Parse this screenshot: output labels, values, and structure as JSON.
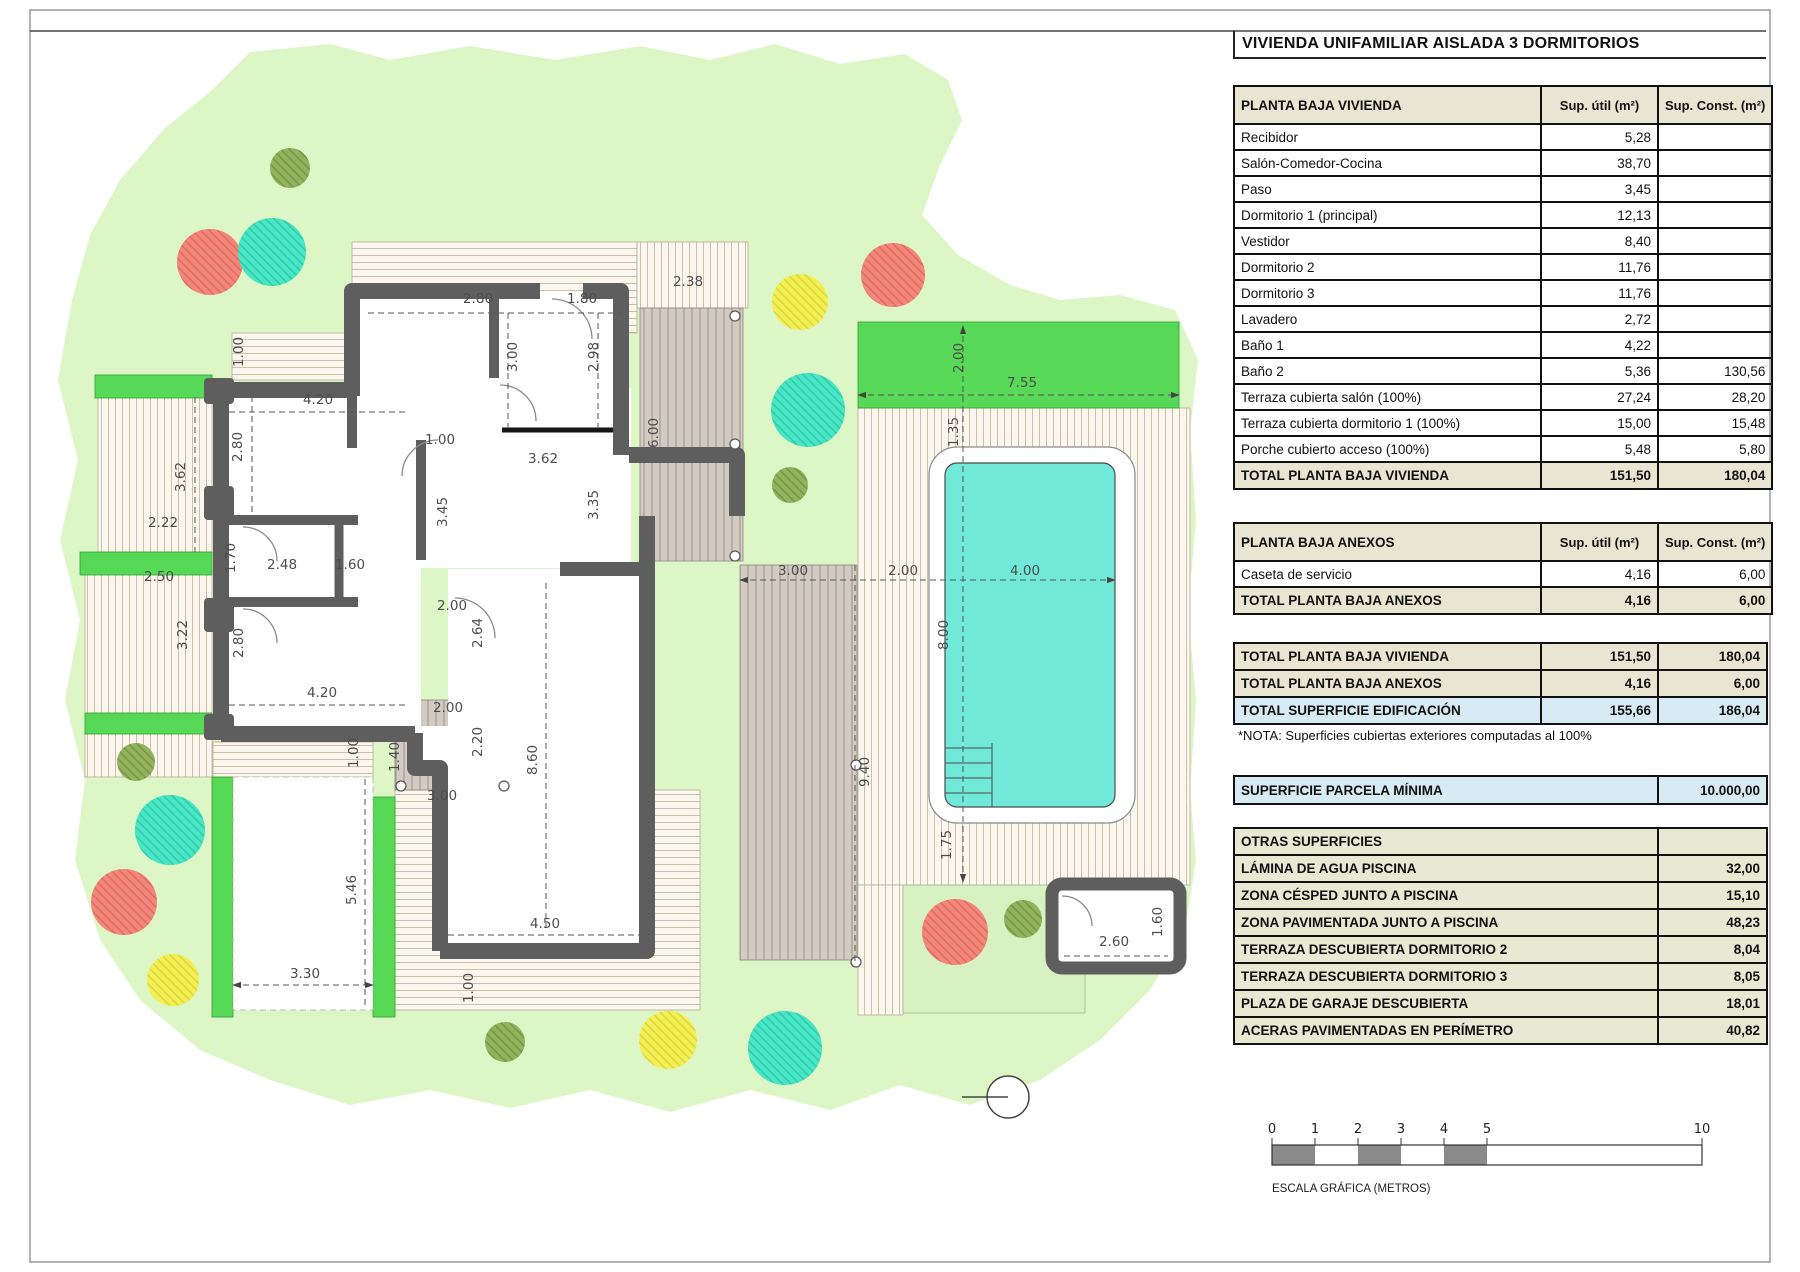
{
  "title": "VIVIENDA UNIFAMILIAR AISLADA 3 DORMITORIOS",
  "tables": {
    "planta_baja": {
      "header": "PLANTA BAJA VIVIENDA",
      "col_util": "Sup. útil\n(m²)",
      "col_const": "Sup. Const.\n(m²)",
      "rows": [
        {
          "label": "Recibidor",
          "util": "5,28",
          "const": ""
        },
        {
          "label": "Salón-Comedor-Cocina",
          "util": "38,70",
          "const": ""
        },
        {
          "label": "Paso",
          "util": "3,45",
          "const": ""
        },
        {
          "label": "Dormitorio 1 (principal)",
          "util": "12,13",
          "const": ""
        },
        {
          "label": "Vestidor",
          "util": "8,40",
          "const": ""
        },
        {
          "label": "Dormitorio 2",
          "util": "11,76",
          "const": ""
        },
        {
          "label": "Dormitorio 3",
          "util": "11,76",
          "const": ""
        },
        {
          "label": "Lavadero",
          "util": "2,72",
          "const": ""
        },
        {
          "label": "Baño 1",
          "util": "4,22",
          "const": ""
        },
        {
          "label": "Baño 2",
          "util": "5,36",
          "const": "130,56"
        },
        {
          "label": "Terraza cubierta salón (100%)",
          "util": "27,24",
          "const": "28,20"
        },
        {
          "label": "Terraza cubierta dormitorio 1 (100%)",
          "util": "15,00",
          "const": "15,48"
        },
        {
          "label": "Porche cubierto acceso (100%)",
          "util": "5,48",
          "const": "5,80"
        }
      ],
      "total": {
        "label": "TOTAL PLANTA BAJA VIVIENDA",
        "util": "151,50",
        "const": "180,04"
      }
    },
    "anexos": {
      "header": "PLANTA BAJA ANEXOS",
      "col_util": "Sup. útil\n(m²)",
      "col_const": "Sup. Const.\n(m²)",
      "rows": [
        {
          "label": "Caseta de servicio",
          "util": "4,16",
          "const": "6,00"
        }
      ],
      "total": {
        "label": "TOTAL PLANTA BAJA ANEXOS",
        "util": "4,16",
        "const": "6,00"
      }
    },
    "resumen": {
      "rows": [
        {
          "label": "TOTAL PLANTA BAJA VIVIENDA",
          "util": "151,50",
          "const": "180,04",
          "style": "tot"
        },
        {
          "label": "TOTAL PLANTA BAJA ANEXOS",
          "util": "4,16",
          "const": "6,00",
          "style": "tot"
        },
        {
          "label": "TOTAL SUPERFICIE EDIFICACIÓN",
          "util": "155,66",
          "const": "186,04",
          "style": "blue"
        }
      ]
    },
    "nota": "*NOTA: Superficies cubiertas exteriores computadas al 100%",
    "parcela": {
      "label": "SUPERFICIE PARCELA MÍNIMA",
      "value": "10.000,00"
    },
    "otras": {
      "header": "OTRAS SUPERFICIES",
      "rows": [
        {
          "label": "LÁMINA DE AGUA PISCINA",
          "value": "32,00"
        },
        {
          "label": "ZONA CÉSPED JUNTO A PISCINA",
          "value": "15,10"
        },
        {
          "label": "ZONA PAVIMENTADA JUNTO A PISCINA",
          "value": "48,23"
        },
        {
          "label": "TERRAZA DESCUBIERTA DORMITORIO 2",
          "value": "8,04"
        },
        {
          "label": "TERRAZA DESCUBIERTA DORMITORIO 3",
          "value": "8,05"
        },
        {
          "label": "PLAZA DE GARAJE DESCUBIERTA",
          "value": "18,01"
        },
        {
          "label": "ACERAS PAVIMENTADAS EN PERÍMETRO",
          "value": "40,82"
        }
      ]
    }
  },
  "scalebar": {
    "caption": "ESCALA GRÁFICA (METROS)",
    "ticks": [
      0,
      1,
      2,
      3,
      4,
      5,
      10
    ],
    "filled_segments": [
      [
        0,
        1
      ],
      [
        2,
        3
      ],
      [
        4,
        5
      ]
    ],
    "x0": 1272,
    "px_per_m": 43,
    "y": 1145,
    "h": 20
  },
  "plan": {
    "colors": {
      "garden": "#ddf6c6",
      "lawn": "#d7f1c0",
      "bright_green": "#57d957",
      "pool_water": "#70e9d9",
      "wall": "#5e5e5e",
      "deck_bg": "#fbf7ee",
      "deck_line": "#cdbfa9",
      "gray_deck_bg": "#d3cbc3",
      "gray_deck_line": "#a79c90",
      "dim_text": "#4d4d4d"
    },
    "dimensions": [
      {
        "t": "1.00",
        "x": 243,
        "y": 352,
        "r": 90
      },
      {
        "t": "2.80",
        "x": 478,
        "y": 303,
        "r": 0
      },
      {
        "t": "1.80",
        "x": 582,
        "y": 303,
        "r": 0
      },
      {
        "t": "2.38",
        "x": 688,
        "y": 286,
        "r": 0
      },
      {
        "t": "3.00",
        "x": 517,
        "y": 357,
        "r": 90
      },
      {
        "t": "2.98",
        "x": 598,
        "y": 357,
        "r": 90
      },
      {
        "t": "6.00",
        "x": 658,
        "y": 433,
        "r": 90
      },
      {
        "t": "4.20",
        "x": 318,
        "y": 404,
        "r": 0
      },
      {
        "t": "2.80",
        "x": 242,
        "y": 447,
        "r": 90
      },
      {
        "t": "3.62",
        "x": 185,
        "y": 477,
        "r": 90
      },
      {
        "t": "1.00",
        "x": 440,
        "y": 444,
        "r": 0
      },
      {
        "t": "3.62",
        "x": 543,
        "y": 463,
        "r": 0
      },
      {
        "t": "3.45",
        "x": 447,
        "y": 512,
        "r": 90
      },
      {
        "t": "3.35",
        "x": 598,
        "y": 505,
        "r": 90
      },
      {
        "t": "2.22",
        "x": 163,
        "y": 527,
        "r": 0
      },
      {
        "t": "1.70",
        "x": 235,
        "y": 558,
        "r": 90
      },
      {
        "t": "2.48",
        "x": 282,
        "y": 569,
        "r": 0
      },
      {
        "t": "1.60",
        "x": 350,
        "y": 569,
        "r": 0
      },
      {
        "t": "2.50",
        "x": 159,
        "y": 581,
        "r": 0
      },
      {
        "t": "3.22",
        "x": 187,
        "y": 635,
        "r": 90
      },
      {
        "t": "2.80",
        "x": 243,
        "y": 643,
        "r": 90
      },
      {
        "t": "2.00",
        "x": 452,
        "y": 610,
        "r": 0
      },
      {
        "t": "2.64",
        "x": 482,
        "y": 633,
        "r": 90
      },
      {
        "t": "4.20",
        "x": 322,
        "y": 697,
        "r": 0
      },
      {
        "t": "2.00",
        "x": 448,
        "y": 712,
        "r": 0
      },
      {
        "t": "1.00",
        "x": 358,
        "y": 753,
        "r": 90
      },
      {
        "t": "1.40",
        "x": 399,
        "y": 757,
        "r": 90
      },
      {
        "t": "2.20",
        "x": 482,
        "y": 742,
        "r": 90
      },
      {
        "t": "8.60",
        "x": 537,
        "y": 760,
        "r": 90
      },
      {
        "t": "3.00",
        "x": 442,
        "y": 800,
        "r": 0
      },
      {
        "t": "5.46",
        "x": 356,
        "y": 890,
        "r": 90
      },
      {
        "t": "3.30",
        "x": 305,
        "y": 978,
        "r": 0
      },
      {
        "t": "1.00",
        "x": 473,
        "y": 988,
        "r": 90
      },
      {
        "t": "4.50",
        "x": 545,
        "y": 928,
        "r": 0
      },
      {
        "t": "2.00",
        "x": 963,
        "y": 358,
        "r": 90
      },
      {
        "t": "7.55",
        "x": 1022,
        "y": 387,
        "r": 0
      },
      {
        "t": "1.35",
        "x": 958,
        "y": 432,
        "r": 90
      },
      {
        "t": "3.00",
        "x": 793,
        "y": 575,
        "r": 0
      },
      {
        "t": "2.00",
        "x": 903,
        "y": 575,
        "r": 0
      },
      {
        "t": "4.00",
        "x": 1025,
        "y": 575,
        "r": 0
      },
      {
        "t": "8.00",
        "x": 948,
        "y": 635,
        "r": 90
      },
      {
        "t": "9.40",
        "x": 869,
        "y": 772,
        "r": 90
      },
      {
        "t": "1.75",
        "x": 951,
        "y": 845,
        "r": 90
      },
      {
        "t": "2.60",
        "x": 1114,
        "y": 946,
        "r": 0
      },
      {
        "t": "1.60",
        "x": 1162,
        "y": 922,
        "r": 90
      }
    ],
    "trees": [
      {
        "x": 290,
        "y": 168,
        "rad": 20,
        "c": "olive"
      },
      {
        "x": 210,
        "y": 262,
        "rad": 33,
        "c": "salmon"
      },
      {
        "x": 272,
        "y": 252,
        "rad": 34,
        "c": "teal"
      },
      {
        "x": 800,
        "y": 302,
        "rad": 28,
        "c": "yellow"
      },
      {
        "x": 893,
        "y": 275,
        "rad": 32,
        "c": "salmon"
      },
      {
        "x": 808,
        "y": 410,
        "rad": 37,
        "c": "teal"
      },
      {
        "x": 790,
        "y": 485,
        "rad": 18,
        "c": "olive"
      },
      {
        "x": 136,
        "y": 762,
        "rad": 19,
        "c": "olive"
      },
      {
        "x": 170,
        "y": 830,
        "rad": 35,
        "c": "teal"
      },
      {
        "x": 124,
        "y": 902,
        "rad": 33,
        "c": "salmon"
      },
      {
        "x": 173,
        "y": 980,
        "rad": 26,
        "c": "yellow"
      },
      {
        "x": 505,
        "y": 1042,
        "rad": 20,
        "c": "olive"
      },
      {
        "x": 668,
        "y": 1040,
        "rad": 29,
        "c": "yellow"
      },
      {
        "x": 785,
        "y": 1048,
        "rad": 37,
        "c": "teal"
      },
      {
        "x": 955,
        "y": 932,
        "rad": 33,
        "c": "salmon"
      },
      {
        "x": 1023,
        "y": 919,
        "rad": 19,
        "c": "olive"
      }
    ]
  }
}
